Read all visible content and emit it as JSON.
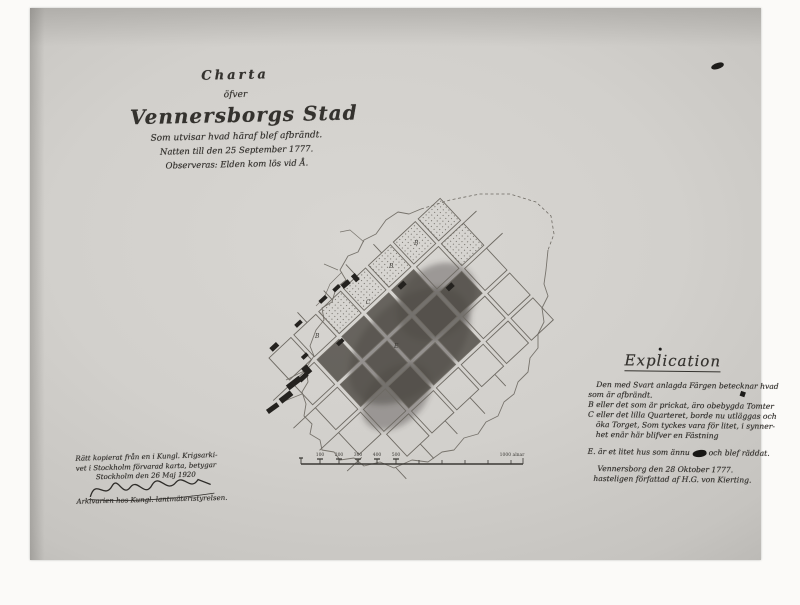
{
  "photo": {
    "description_colors": {
      "paper": "#d3d1cd",
      "burned_area": "#4e4a44",
      "ink": "#34322e"
    }
  },
  "title_block": {
    "charta": "Charta",
    "ofver": "öfver",
    "city": "Vennersborgs Stad",
    "sub1": "Som utvisar hvad häraf blef afbrändt.",
    "sub2": "Natten till den 25 September 1777.",
    "sub3": "Observeras: Elden kom lös vid Å."
  },
  "explication": {
    "title": "Explication",
    "lines": [
      "Den med Svart anlagda Färgen betecknar hvad",
      "som är afbrändt.",
      "B eller det som är prickat, äro obebygda Tomter",
      "C eller det lilla Quarteret, borde nu utläggas och",
      "öka Torget, Som tyckes vara för litet, i synner-",
      "het enär här blifver en Fästning"
    ],
    "rescued_before": "E. är et litet hus som ännu",
    "rescued_after": "och blef räddat.",
    "date_line": "Vennersborg den 28 Oktober 1777.",
    "author_line": "hasteligen författad af H.G. von Kierting."
  },
  "certification": {
    "line1": "Rätt kopierat från en i Kungl. Krigsarki-",
    "line2": "vet i Stockholm förvarad karta, betygar",
    "line3": "Stockholm den 26 Maj 1920",
    "footer": "Arkivarien hos Kungl. lantmäteristyrelsen."
  },
  "scale_bar": {
    "tick_labels": [
      "100",
      "200",
      "300",
      "400",
      "500"
    ],
    "end_label": "1000 alnar"
  },
  "map": {
    "labels": [
      "B",
      "B",
      "B",
      "C",
      "E"
    ]
  }
}
